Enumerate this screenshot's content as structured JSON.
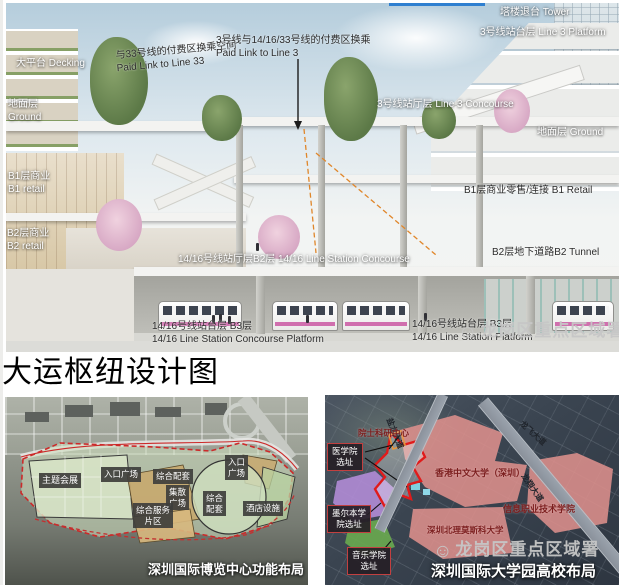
{
  "page": {
    "title": "大运枢纽设计图"
  },
  "watermark": {
    "text": "龙岗区重点区域署",
    "icon": "smiley-face-icon"
  },
  "colors": {
    "boundary_red": "#e02020",
    "campus_pink": "#dd8f8c",
    "campus_purple": "#b18cd6",
    "campus_green": "#69a84f",
    "expo_site_green": "#cfe0bf",
    "expo_zone_tan": "#c9a86b",
    "label_box_dark": "#3e3e3c",
    "train_stripe_pink": "#d06fae",
    "sky_blue": "#b5cddc"
  },
  "top_diagram": {
    "labels": [
      {
        "cn": "塔楼退台",
        "en": "Tower"
      },
      {
        "cn": "3号线站台层",
        "en": "Line 3 Platform"
      },
      {
        "cn": "与33号线的付费区换乘空间",
        "en": "Paid Link to Line 33"
      },
      {
        "cn": "3号线与14/16/33号线的付费区换乘",
        "en": "Paid Link to Line 3"
      },
      {
        "cn": "大平台",
        "en": "Decking"
      },
      {
        "cn": "地面层",
        "en": "Ground"
      },
      {
        "cn": "3号线站厅层",
        "en": "Line 3 Concourse"
      },
      {
        "cn": "地面层",
        "en": "Ground"
      },
      {
        "cn": "B1层商业",
        "en": "B1 retail"
      },
      {
        "cn": "B1层商业零售/连接",
        "en": "B1 Retail"
      },
      {
        "cn": "B2层商业",
        "en": "B2 retail"
      },
      {
        "cn": "B2层地下道路",
        "en": "B2 Tunnel"
      },
      {
        "cn": "14/16号线站厅层B2层",
        "en": "14/16 Line Station Concourse"
      },
      {
        "cn": "14/16号线站台层 B3层",
        "en": "14/16 Line Station Concourse Platform"
      },
      {
        "cn": "14/16号线站台层 B3层",
        "en": "14/16 Line Station Platform"
      }
    ]
  },
  "expo_map": {
    "caption": "深圳国际博览中心功能布局",
    "zones": [
      {
        "lines": [
          "主题会展"
        ]
      },
      {
        "lines": [
          "入口广场"
        ]
      },
      {
        "lines": [
          "综合配套"
        ]
      },
      {
        "lines": [
          "入口",
          "广场"
        ]
      },
      {
        "lines": [
          "集散",
          "广场"
        ]
      },
      {
        "lines": [
          "综合服务",
          "片区"
        ]
      },
      {
        "lines": [
          "综合",
          "配套"
        ]
      },
      {
        "lines": [
          "酒店设施"
        ]
      }
    ]
  },
  "university_map": {
    "caption": "深圳国际大学园高校布局",
    "site_boxes": [
      {
        "lines": [
          "医学院",
          "选址"
        ]
      },
      {
        "lines": [
          "墨尔本学",
          "院选址"
        ]
      },
      {
        "lines": [
          "音乐学院",
          "选址"
        ]
      }
    ],
    "institutions": [
      "院士科研中心",
      "香港中文大学（深圳）",
      "信息职业技术学院",
      "深圳北理莫斯科大学"
    ],
    "roads": [
      "盐龙大道",
      "龙飞大道",
      "龙翔大道"
    ]
  }
}
